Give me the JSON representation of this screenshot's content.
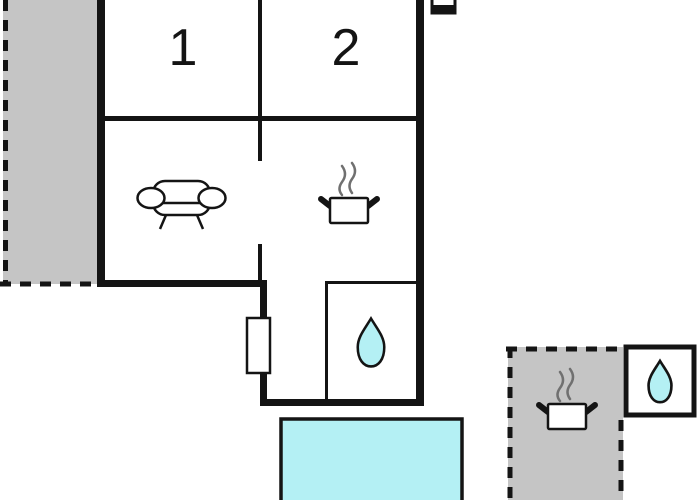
{
  "page": {
    "background": "#ffffff"
  },
  "colors": {
    "wall": "#141414",
    "terrace_fill": "#c5c5c5",
    "water_fill": "#b4f0f4",
    "steam": "#707070",
    "icon_fill": "#ffffff"
  },
  "rooms": [
    {
      "label": "1"
    },
    {
      "label": "2"
    }
  ],
  "icons": {
    "sofa": "sofa",
    "cooking_pot": "cooking-pot",
    "water_drop": "water-drop",
    "tv": "tv",
    "window": "window-marker"
  }
}
